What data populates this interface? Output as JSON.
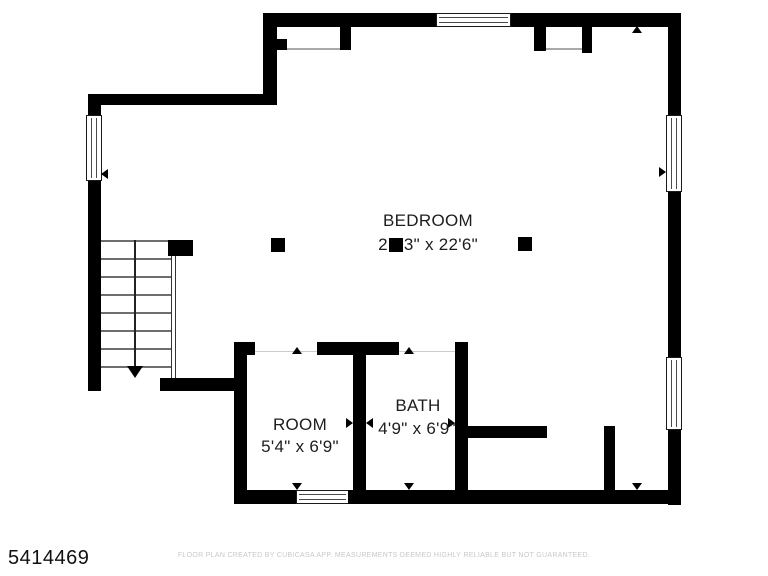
{
  "plan": {
    "bedroom": {
      "label": "BEDROOM",
      "dim_prefix": "2",
      "dim_suffix": "3\" x 22'6\""
    },
    "room": {
      "label": "ROOM",
      "dim": "5'4\" x 6'9\""
    },
    "bath": {
      "label": "BATH",
      "dim": "4'9\" x 6'9\""
    }
  },
  "footer": {
    "listing_id": "5414469",
    "disclaimer": "FLOOR PLAN CREATED BY CUBICASA APP. MEASUREMENTS DEEMED HIGHLY RELIABLE BUT NOT GUARANTEED."
  },
  "colors": {
    "wall": "#000000",
    "label_text": "#1d1d1d",
    "disclaimer_text": "#c8c8c8"
  }
}
